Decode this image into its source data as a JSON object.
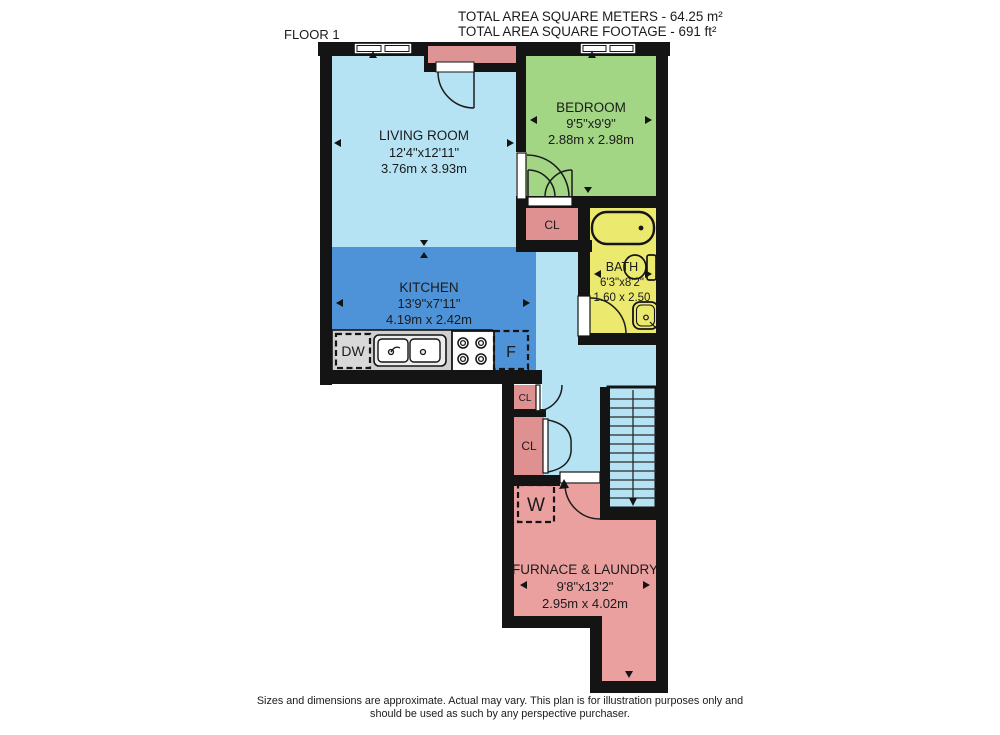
{
  "header": {
    "floor_label": "FLOOR 1",
    "total_area_metric": "TOTAL AREA SQUARE METERS - 64.25 m²",
    "total_area_imperial": "TOTAL AREA SQUARE FOOTAGE - 691 ft²"
  },
  "rooms": {
    "living_room": {
      "name": "LIVING ROOM",
      "size_imperial": "12'4\"x12'11\"",
      "size_metric": "3.76m x 3.93m"
    },
    "bedroom": {
      "name": "BEDROOM",
      "size_imperial": "9'5\"x9'9\"",
      "size_metric": "2.88m x 2.98m"
    },
    "kitchen": {
      "name": "KITCHEN",
      "size_imperial": "13'9\"x7'11\"",
      "size_metric": "4.19m x 2.42m"
    },
    "bath": {
      "name": "BATH",
      "size_imperial": "6'3\"x8'2\"",
      "size_metric": "1.60 x 2.50"
    },
    "furnace_laundry": {
      "name": "FURNACE & LAUNDRY",
      "size_imperial": "9'8\"x13'2\"",
      "size_metric": "2.95m x 4.02m"
    }
  },
  "labels": {
    "closet": "CL",
    "washer": "W",
    "dishwasher": "DW",
    "fridge": "F"
  },
  "colors": {
    "wall": "#141414",
    "living_room": "#b6e3f3",
    "hallway": "#b6e3f3",
    "kitchen": "#4e93d8",
    "bedroom": "#a2d584",
    "bath": "#ece96f",
    "closet": "#df9090",
    "furnace": "#eba0a0",
    "entry": "#dc9494",
    "counter": "#cfcfcf"
  },
  "footer": {
    "line1": "Sizes and dimensions are approximate. Actual may vary. This plan is for illustration purposes only and",
    "line2": "should be used as such by any perspective purchaser."
  }
}
